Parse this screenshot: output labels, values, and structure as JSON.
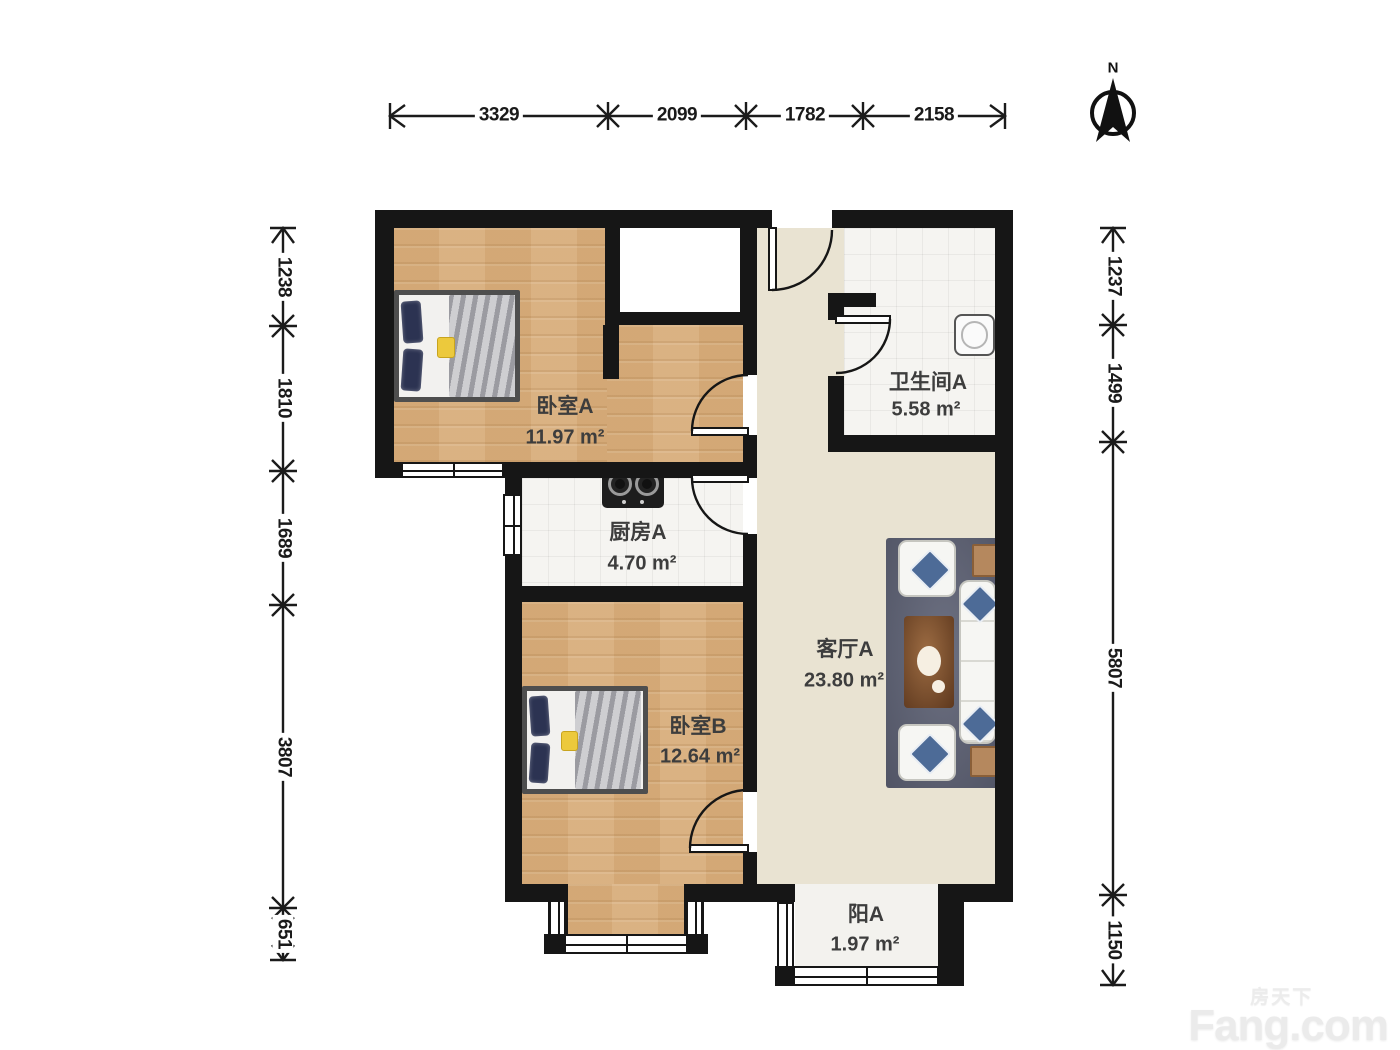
{
  "title": "两室一厅户型图",
  "compass": {
    "north_label": "N"
  },
  "watermark": {
    "brand_cn": "房天下",
    "brand_en": "Fang.com"
  },
  "dimensions_mm": {
    "top": [
      "3329",
      "2099",
      "1782",
      "2158"
    ],
    "left": [
      "1238",
      "1810",
      "1689",
      "3807",
      "651"
    ],
    "right": [
      "1237",
      "1499",
      "5807",
      "1150"
    ]
  },
  "rooms": {
    "bedroom_a": {
      "name": "卧室A",
      "area": "11.97 m²"
    },
    "bathroom_a": {
      "name": "卫生间A",
      "area": "5.58 m²"
    },
    "kitchen_a": {
      "name": "厨房A",
      "area": "4.70 m²"
    },
    "bedroom_b": {
      "name": "卧室B",
      "area": "12.64 m²"
    },
    "living_a": {
      "name": "客厅A",
      "area": "23.80 m²"
    },
    "balcony_a": {
      "name": "阳A",
      "area": "1.97 m²"
    }
  },
  "colors": {
    "wall": "#161616",
    "wood_floor": "#d8ae7c",
    "living_floor": "#e9e3d2",
    "tile_floor": "#f5f4f1",
    "rug": "#5c6073",
    "pillow_accent": "#4d6b97",
    "coffee_table": "#7c4a27",
    "bed_pillow": "#2c3352",
    "yellow_accent": "#ecc93c"
  }
}
